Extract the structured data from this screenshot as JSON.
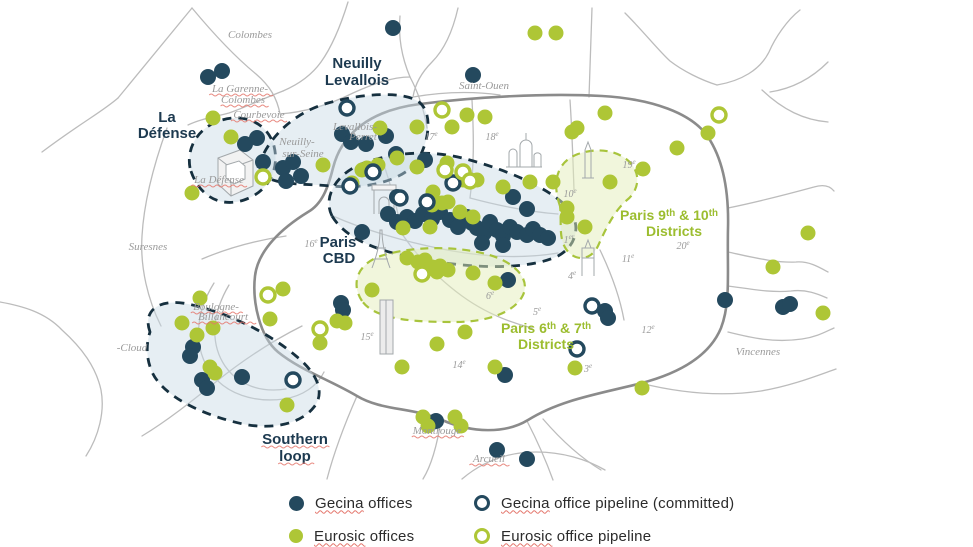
{
  "colors": {
    "gecina_navy": "#24495e",
    "eurosic_green": "#aec636",
    "area_label_navy": "#1d3a50",
    "area_label_green": "#9cbd2f",
    "navy_dash": "#16303f",
    "green_dash": "#a8c43c",
    "road_gray": "#bcbcbc",
    "boundary_gray": "#8b8b8b",
    "place_label_gray": "#9a9a9a",
    "region_blue_fill": "rgba(199,217,229,0.45)",
    "region_green_fill": "rgba(228,238,185,0.5)"
  },
  "map": {
    "markers": {
      "gecina_offices": [
        [
          208,
          77
        ],
        [
          222,
          71
        ],
        [
          393,
          28
        ],
        [
          473,
          75
        ],
        [
          245,
          144
        ],
        [
          257,
          138
        ],
        [
          342,
          134
        ],
        [
          351,
          142
        ],
        [
          366,
          144
        ],
        [
          386,
          136
        ],
        [
          396,
          154
        ],
        [
          263,
          162
        ],
        [
          283,
          168
        ],
        [
          293,
          162
        ],
        [
          301,
          176
        ],
        [
          286,
          181
        ],
        [
          425,
          160
        ],
        [
          513,
          197
        ],
        [
          527,
          209
        ],
        [
          397,
          197
        ],
        [
          362,
          232
        ],
        [
          388,
          214
        ],
        [
          397,
          222
        ],
        [
          407,
          217
        ],
        [
          415,
          221
        ],
        [
          423,
          214
        ],
        [
          432,
          219
        ],
        [
          440,
          212
        ],
        [
          450,
          220
        ],
        [
          458,
          227
        ],
        [
          467,
          217
        ],
        [
          472,
          223
        ],
        [
          477,
          228
        ],
        [
          484,
          233
        ],
        [
          490,
          222
        ],
        [
          497,
          230
        ],
        [
          503,
          236
        ],
        [
          510,
          227
        ],
        [
          517,
          232
        ],
        [
          527,
          235
        ],
        [
          533,
          229
        ],
        [
          540,
          235
        ],
        [
          548,
          238
        ],
        [
          482,
          243
        ],
        [
          503,
          245
        ],
        [
          508,
          280
        ],
        [
          605,
          311
        ],
        [
          608,
          318
        ],
        [
          725,
          300
        ],
        [
          783,
          307
        ],
        [
          790,
          304
        ],
        [
          505,
          375
        ],
        [
          436,
          421
        ],
        [
          497,
          450
        ],
        [
          527,
          459
        ],
        [
          193,
          347
        ],
        [
          190,
          356
        ],
        [
          202,
          380
        ],
        [
          207,
          388
        ],
        [
          242,
          377
        ],
        [
          341,
          303
        ],
        [
          343,
          310
        ]
      ],
      "eurosic_offices": [
        [
          535,
          33
        ],
        [
          556,
          33
        ],
        [
          213,
          118
        ],
        [
          231,
          137
        ],
        [
          192,
          193
        ],
        [
          467,
          115
        ],
        [
          485,
          117
        ],
        [
          452,
          127
        ],
        [
          605,
          113
        ],
        [
          577,
          128
        ],
        [
          708,
          133
        ],
        [
          417,
          127
        ],
        [
          380,
          128
        ],
        [
          397,
          158
        ],
        [
          323,
          165
        ],
        [
          362,
          170
        ],
        [
          417,
          167
        ],
        [
          447,
          163
        ],
        [
          378,
          165
        ],
        [
          367,
          168
        ],
        [
          352,
          183
        ],
        [
          463,
          180
        ],
        [
          477,
          180
        ],
        [
          433,
          192
        ],
        [
          448,
          202
        ],
        [
          460,
          212
        ],
        [
          473,
          217
        ],
        [
          403,
          228
        ],
        [
          430,
          227
        ],
        [
          442,
          203
        ],
        [
          432,
          205
        ],
        [
          503,
          187
        ],
        [
          530,
          182
        ],
        [
          553,
          182
        ],
        [
          572,
          132
        ],
        [
          567,
          217
        ],
        [
          495,
          283
        ],
        [
          643,
          169
        ],
        [
          610,
          182
        ],
        [
          677,
          148
        ],
        [
          567,
          208
        ],
        [
          585,
          227
        ],
        [
          808,
          233
        ],
        [
          773,
          267
        ],
        [
          823,
          313
        ],
        [
          642,
          388
        ],
        [
          407,
          258
        ],
        [
          425,
          260
        ],
        [
          432,
          267
        ],
        [
          440,
          266
        ],
        [
          448,
          270
        ],
        [
          437,
          272
        ],
        [
          418,
          262
        ],
        [
          473,
          273
        ],
        [
          372,
          290
        ],
        [
          465,
          332
        ],
        [
          437,
          344
        ],
        [
          402,
          367
        ],
        [
          495,
          367
        ],
        [
          575,
          368
        ],
        [
          423,
          417
        ],
        [
          428,
          426
        ],
        [
          455,
          417
        ],
        [
          461,
          426
        ],
        [
          287,
          405
        ],
        [
          182,
          323
        ],
        [
          197,
          335
        ],
        [
          213,
          328
        ],
        [
          210,
          367
        ],
        [
          215,
          373
        ],
        [
          200,
          298
        ],
        [
          337,
          321
        ],
        [
          345,
          323
        ],
        [
          320,
          343
        ],
        [
          270,
          319
        ],
        [
          283,
          289
        ]
      ],
      "gecina_pipeline": [
        [
          347,
          108
        ],
        [
          373,
          172
        ],
        [
          350,
          186
        ],
        [
          400,
          198
        ],
        [
          427,
          202
        ],
        [
          453,
          183
        ],
        [
          592,
          306
        ],
        [
          577,
          349
        ],
        [
          293,
          380
        ]
      ],
      "eurosic_pipeline": [
        [
          719,
          115
        ],
        [
          442,
          110
        ],
        [
          263,
          177
        ],
        [
          268,
          295
        ],
        [
          320,
          329
        ],
        [
          422,
          274
        ],
        [
          445,
          170
        ],
        [
          463,
          172
        ],
        [
          470,
          181
        ]
      ]
    },
    "place_labels": [
      {
        "text": "Colombes",
        "x": 250,
        "y": 38
      },
      {
        "text": "La Garenne-",
        "x": 240,
        "y": 92,
        "wavy": true
      },
      {
        "text": "Colombes",
        "x": 243,
        "y": 103,
        "wavy": true
      },
      {
        "text": "Courbevoie",
        "x": 259,
        "y": 118,
        "wavy": true
      },
      {
        "text": "Neuilly-",
        "x": 297,
        "y": 145
      },
      {
        "text": "sur-Seine",
        "x": 303,
        "y": 157
      },
      {
        "text": "Levallois-",
        "x": 355,
        "y": 130
      },
      {
        "text": "Perret",
        "x": 363,
        "y": 140
      },
      {
        "text": "La Défense",
        "x": 219,
        "y": 183,
        "wavy": true
      },
      {
        "text": "Saint-Ouen",
        "x": 484,
        "y": 89
      },
      {
        "text": "Suresnes",
        "x": 148,
        "y": 250
      },
      {
        "text": "Boulogne-",
        "x": 216,
        "y": 310,
        "wavy": true
      },
      {
        "text": "Billancourt",
        "x": 223,
        "y": 320,
        "wavy": true
      },
      {
        "text": "-Cloud",
        "x": 132,
        "y": 351
      },
      {
        "text": "Montrouge",
        "x": 437,
        "y": 434,
        "wavy": true
      },
      {
        "text": "Arcueil",
        "x": 489,
        "y": 462,
        "wavy": true
      },
      {
        "text": "Vincennes",
        "x": 758,
        "y": 355
      }
    ],
    "district_labels": [
      {
        "text": "17^{e}",
        "x": 431,
        "y": 140
      },
      {
        "text": "18^{e}",
        "x": 492,
        "y": 140
      },
      {
        "text": "19^{e}",
        "x": 629,
        "y": 168
      },
      {
        "text": "10^{e}",
        "x": 570,
        "y": 197
      },
      {
        "text": "16^{e}",
        "x": 311,
        "y": 247
      },
      {
        "text": "20^{e}",
        "x": 683,
        "y": 249
      },
      {
        "text": "11^{e}",
        "x": 628,
        "y": 262
      },
      {
        "text": "12^{e}",
        "x": 648,
        "y": 333
      },
      {
        "text": "1^{er}",
        "x": 569,
        "y": 243
      },
      {
        "text": "4^{e}",
        "x": 572,
        "y": 279
      },
      {
        "text": "5^{e}",
        "x": 537,
        "y": 315
      },
      {
        "text": "6^{e}",
        "x": 490,
        "y": 299
      },
      {
        "text": "3^{e}",
        "x": 588,
        "y": 372
      },
      {
        "text": "15^{e}",
        "x": 367,
        "y": 340
      },
      {
        "text": "14^{e}",
        "x": 459,
        "y": 368
      }
    ],
    "area_labels": [
      {
        "text": "La",
        "x": 167,
        "y": 122,
        "style": "navy"
      },
      {
        "text": "Défense",
        "x": 167,
        "y": 138,
        "style": "navy"
      },
      {
        "text": "Neuilly",
        "x": 357,
        "y": 68,
        "style": "navy"
      },
      {
        "text": "Levallois",
        "x": 357,
        "y": 85,
        "style": "navy"
      },
      {
        "text": "Paris",
        "x": 338,
        "y": 247,
        "style": "navy"
      },
      {
        "text": "CBD",
        "x": 339,
        "y": 263,
        "style": "navy"
      },
      {
        "text": "Southern",
        "x": 295,
        "y": 444,
        "style": "navy",
        "wavy": true
      },
      {
        "text": "loop",
        "x": 295,
        "y": 461,
        "style": "navy",
        "wavy": true
      },
      {
        "text": "Paris 9^{th} & 10^{th}",
        "x": 669,
        "y": 220,
        "style": "green"
      },
      {
        "text": "Districts",
        "x": 674,
        "y": 236,
        "style": "green"
      },
      {
        "text": "Paris 6^{th} & 7^{th}",
        "x": 546,
        "y": 333,
        "style": "green"
      },
      {
        "text": "Districts",
        "x": 546,
        "y": 349,
        "style": "green"
      }
    ]
  },
  "legend": {
    "items": [
      {
        "brand": "Gecina",
        "rest": " offices"
      },
      {
        "brand": "Eurosic",
        "rest": " offices"
      },
      {
        "brand": "Gecina",
        "rest": " office pipeline (committed)"
      },
      {
        "brand": "Eurosic",
        "rest": " office pipeline"
      }
    ]
  }
}
